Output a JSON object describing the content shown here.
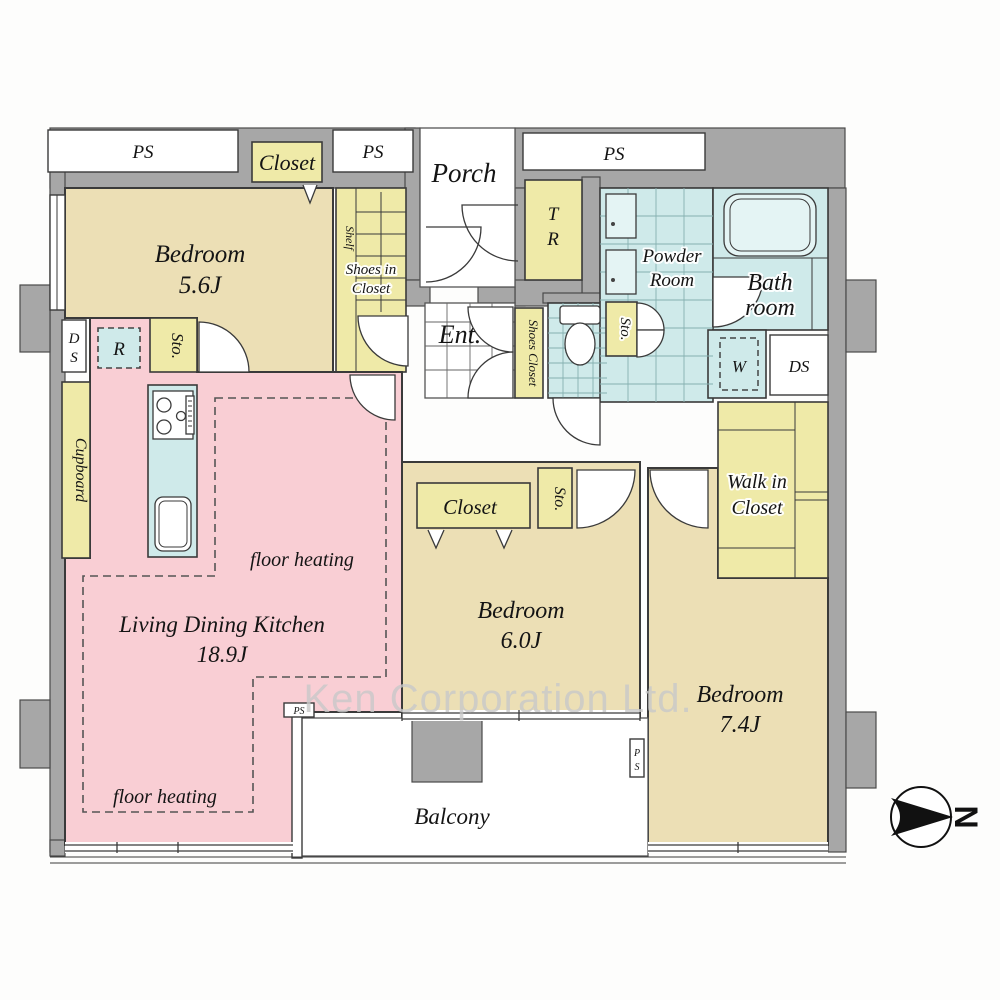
{
  "plan": {
    "watermark": "Ken Corporation Ltd.",
    "compass": {
      "north": "N"
    },
    "rooms": {
      "bedroom_1": {
        "name": "Bedroom",
        "size": "5.6J"
      },
      "bedroom_2": {
        "name": "Bedroom",
        "size": "6.0J"
      },
      "bedroom_3": {
        "name": "Bedroom",
        "size": "7.4J"
      },
      "ldk": {
        "name": "Living Dining Kitchen",
        "size": "18.9J"
      },
      "porch": {
        "name": "Porch"
      },
      "entrance": {
        "name": "Ent."
      },
      "balcony": {
        "name": "Balcony"
      },
      "bathroom": {
        "line1": "Bath",
        "line2": "room"
      },
      "powder_room": {
        "line1": "Powder",
        "line2": "Room"
      },
      "walk_in_closet": {
        "line1": "Walk in",
        "line2": "Closet"
      },
      "trunk_room": {
        "line1": "T",
        "line2": "R"
      }
    },
    "storage": {
      "closet_bedroom1": "Closet",
      "closet_bedroom2": "Closet",
      "shoes_in_closet_line1": "Shoes in",
      "shoes_in_closet_line2": "Closet",
      "shelf": "Shelf",
      "shoes_closet": "Shoes Closet",
      "cupboard": "Cupboard",
      "sto": "Sto."
    },
    "utilities": {
      "ps": "PS",
      "ps_p": "P",
      "ps_s": "S",
      "ds": "DS",
      "ds_d": "D",
      "ds_s": "S",
      "refrigerator": "R",
      "washer": "W"
    },
    "notes": {
      "floor_heating": "floor heating"
    },
    "colors": {
      "wall": "#a7a7a7",
      "bedroom_fill": "#ecdfb5",
      "ldk_fill": "#f9ced4",
      "closet_fill": "#efeaa8",
      "wet_fill": "#cfeaea",
      "line": "#3a3a3a",
      "watermark_color": "#c9c9c9"
    }
  }
}
